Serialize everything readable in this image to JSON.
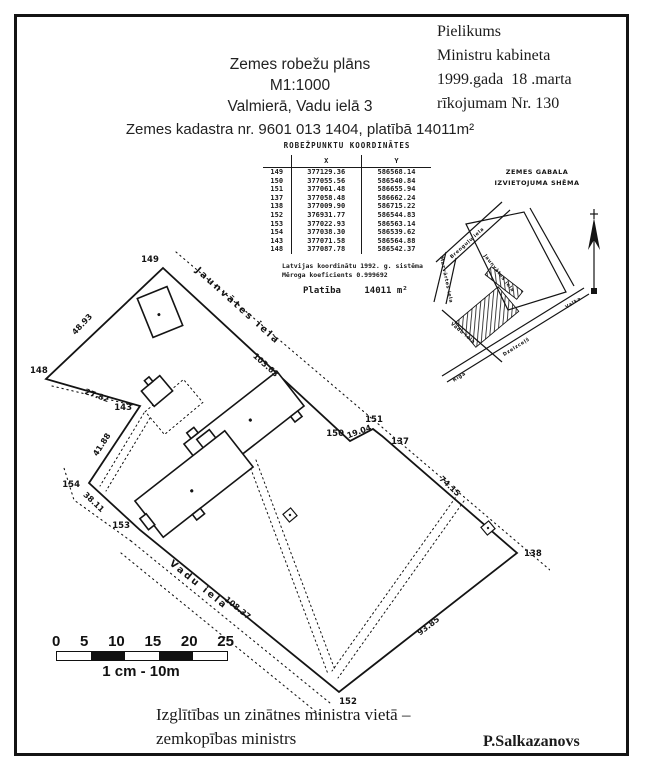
{
  "header": {
    "title_lines": [
      "Zemes robežu plāns",
      "M1:1000",
      "Valmierā, Vadu ielā 3"
    ],
    "subtitle": "Zemes kadastra nr. 9601 013 1404, platībā 14011m²",
    "annex_lines": [
      "Pielikums",
      "Ministru kabineta",
      "1999.gada  18 .marta",
      "rīkojumam Nr. 130"
    ]
  },
  "coords_table": {
    "title": "ROBEŽPUNKTU KOORDINĀTES",
    "col_x": "X",
    "col_y": "Y",
    "rows": [
      [
        "149",
        "377129.36",
        "586568.14"
      ],
      [
        "150",
        "377055.56",
        "586540.84"
      ],
      [
        "151",
        "377061.48",
        "586655.94"
      ],
      [
        "137",
        "377058.48",
        "586662.24"
      ],
      [
        "138",
        "377009.90",
        "586715.22"
      ],
      [
        "152",
        "376931.77",
        "586544.83"
      ],
      [
        "153",
        "377022.93",
        "586563.14"
      ],
      [
        "154",
        "377038.30",
        "586539.62"
      ],
      [
        "143",
        "377071.58",
        "586564.88"
      ],
      [
        "148",
        "377087.78",
        "586542.37"
      ]
    ],
    "note_line1": "Latvijas koordinātu 1992. g. sistēma",
    "note_line2": "Mēroga koeficients 0.999692",
    "area_label": "Platība",
    "area_value": "14011 m²"
  },
  "scheme": {
    "title_line1": "ZEMES GABALA",
    "title_line2": "IZVIETOJUMA SHĒMA",
    "streets": {
      "brengulu": "Brenguļu iela",
      "mazvartes": "Mazvārtes iela",
      "jaunvates": "Jaunvātes iela",
      "vadu": "Vadu iela",
      "railway": "Dzelzceļš",
      "riga": "Rīga",
      "valka": "Valka"
    }
  },
  "plan": {
    "street_top": "Jaunvātes iela",
    "street_bottom": "Vadu iela",
    "points": {
      "p149": "149",
      "p150": "150",
      "p151": "151",
      "p137": "137",
      "p138": "138",
      "p152": "152",
      "p153": "153",
      "p154": "154",
      "p143": "143",
      "p148": "148"
    },
    "dims": {
      "d149_148": "48.93",
      "d148_143": "27.82",
      "d143_154": "41.88",
      "d154_153": "38.11",
      "d153_152": "108.37",
      "d138_152": "93.85",
      "d137_138": "74.15",
      "d150_151": "19.04",
      "d149_150": "103.63"
    }
  },
  "scalebar": {
    "ticks": [
      "0",
      "5",
      "10",
      "15",
      "20",
      "25"
    ],
    "caption": "1 cm - 10m"
  },
  "footer": {
    "line1": "Izglītības un zinātnes ministra vietā –",
    "line2": "zemkopības ministrs",
    "signature": "P.Salkazanovs"
  }
}
